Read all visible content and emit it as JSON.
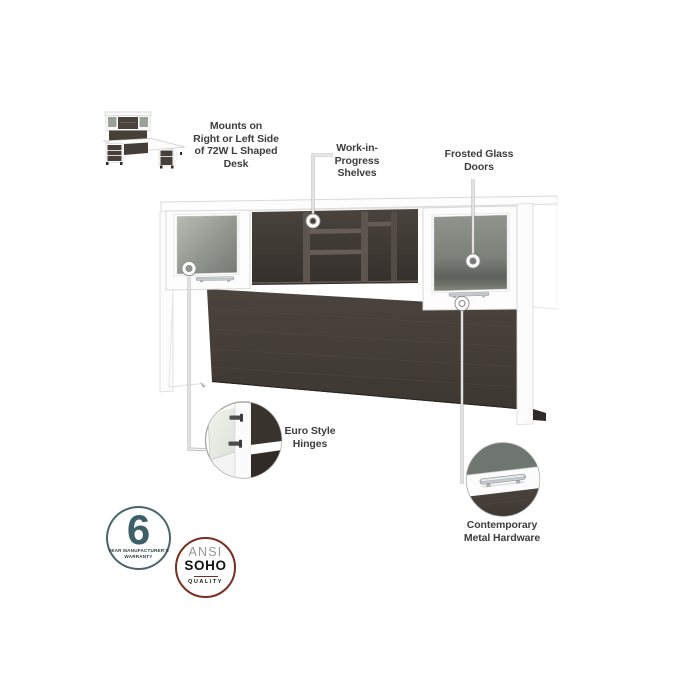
{
  "annotations": {
    "mounts_note": {
      "lines": [
        "Mounts on",
        "Right or Left Side",
        "of 72W L Shaped",
        "Desk"
      ]
    },
    "wip_shelves": {
      "lines": [
        "Work-in-",
        "Progress",
        "Shelves"
      ]
    },
    "frosted_doors": {
      "lines": [
        "Frosted Glass",
        "Doors"
      ]
    },
    "euro_hinges": {
      "lines": [
        "Euro Style",
        "Hinges"
      ]
    },
    "metal_hardware": {
      "lines": [
        "Contemporary",
        "Metal Hardware"
      ]
    }
  },
  "badges": {
    "warranty": {
      "number": "6",
      "caption_line1": "YEAR MANUFACTURER'S",
      "caption_line2": "WARRANTY",
      "ring_color": "#4a656c",
      "number_color": "#3d6067"
    },
    "ansi_soho": {
      "line1": "ANSI",
      "line2": "SOHO",
      "line3": "QUALITY",
      "ring_color": "#7b2d21"
    }
  },
  "colors": {
    "label_text": "#3d3d3d",
    "leader_line": "#9b9b9b",
    "wood_dark": "#463f39",
    "wood_interior": "#332e2a",
    "frosted_glass": "#848a83",
    "hardware_silver": "#c6cacc",
    "furniture_white": "#fdfdfd"
  }
}
